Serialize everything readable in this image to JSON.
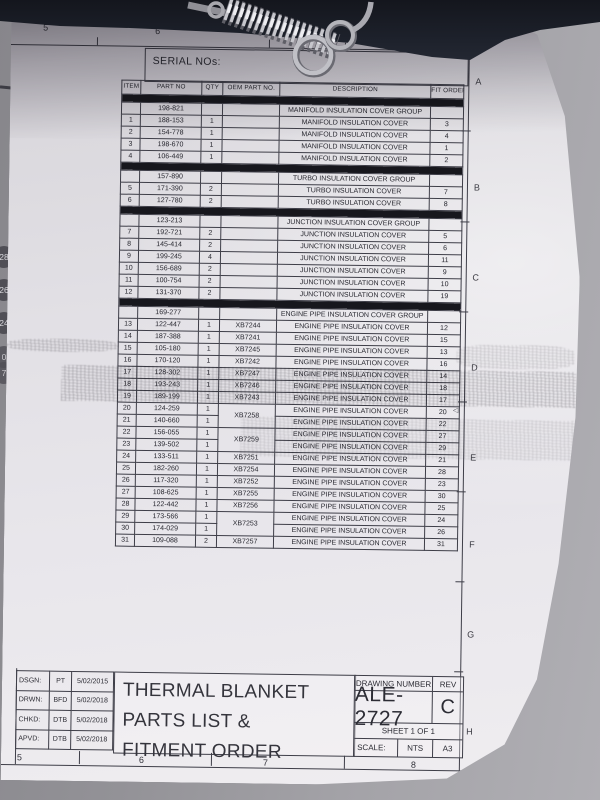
{
  "sheet": {
    "serial_label": "SERIAL NOs:",
    "zone_numbers_top": [
      "5",
      "6",
      "8"
    ],
    "zone_numbers_bottom": [
      "5",
      "6",
      "7",
      "8"
    ],
    "zone_letters": [
      "A",
      "B",
      "C",
      "D",
      "E",
      "F",
      "G",
      "H"
    ],
    "margin_balloons": [
      "28",
      "26",
      "24",
      "0",
      "7"
    ],
    "table": {
      "headers": [
        "ITEM",
        "PART NO",
        "QTY",
        "OEM PART NO.",
        "DESCRIPTION",
        "FIT ORDER"
      ],
      "rows": [
        {
          "type": "bar"
        },
        {
          "type": "group",
          "part": "198-821",
          "desc": "MANIFOLD INSULATION COVER GROUP"
        },
        {
          "type": "item",
          "item": "1",
          "part": "188-153",
          "qty": "1",
          "oem": "",
          "desc": "MANIFOLD INSULATION COVER",
          "fit": "3"
        },
        {
          "type": "item",
          "item": "2",
          "part": "154-778",
          "qty": "1",
          "oem": "",
          "desc": "MANIFOLD INSULATION COVER",
          "fit": "4"
        },
        {
          "type": "item",
          "item": "3",
          "part": "198-670",
          "qty": "1",
          "oem": "",
          "desc": "MANIFOLD INSULATION COVER",
          "fit": "1"
        },
        {
          "type": "item",
          "item": "4",
          "part": "106-449",
          "qty": "1",
          "oem": "",
          "desc": "MANIFOLD INSULATION COVER",
          "fit": "2"
        },
        {
          "type": "bar"
        },
        {
          "type": "group",
          "part": "157-890",
          "desc": "TURBO INSULATION COVER GROUP"
        },
        {
          "type": "item",
          "item": "5",
          "part": "171-390",
          "qty": "2",
          "oem": "",
          "desc": "TURBO INSULATION COVER",
          "fit": "7"
        },
        {
          "type": "item",
          "item": "6",
          "part": "127-780",
          "qty": "2",
          "oem": "",
          "desc": "TURBO INSULATION COVER",
          "fit": "8"
        },
        {
          "type": "bar"
        },
        {
          "type": "group",
          "part": "123-213",
          "desc": "JUNCTION INSULATION COVER GROUP"
        },
        {
          "type": "item",
          "item": "7",
          "part": "192-721",
          "qty": "2",
          "oem": "",
          "desc": "JUNCTION INSULATION COVER",
          "fit": "5"
        },
        {
          "type": "item",
          "item": "8",
          "part": "145-414",
          "qty": "2",
          "oem": "",
          "desc": "JUNCTION INSULATION COVER",
          "fit": "6"
        },
        {
          "type": "item",
          "item": "9",
          "part": "199-245",
          "qty": "4",
          "oem": "",
          "desc": "JUNCTION INSULATION COVER",
          "fit": "11"
        },
        {
          "type": "item",
          "item": "10",
          "part": "156-689",
          "qty": "2",
          "oem": "",
          "desc": "JUNCTION INSULATION COVER",
          "fit": "9"
        },
        {
          "type": "item",
          "item": "11",
          "part": "100-754",
          "qty": "2",
          "oem": "",
          "desc": "JUNCTION INSULATION COVER",
          "fit": "10"
        },
        {
          "type": "item",
          "item": "12",
          "part": "131-370",
          "qty": "2",
          "oem": "",
          "desc": "JUNCTION INSULATION COVER",
          "fit": "19"
        },
        {
          "type": "bar"
        },
        {
          "type": "group",
          "part": "169-277",
          "desc": "ENGINE PIPE INSULATION COVER GROUP"
        },
        {
          "type": "item",
          "item": "13",
          "part": "122-447",
          "qty": "1",
          "oem": "XB7244",
          "desc": "ENGINE PIPE INSULATION COVER",
          "fit": "12"
        },
        {
          "type": "item",
          "item": "14",
          "part": "187-388",
          "qty": "1",
          "oem": "XB7241",
          "desc": "ENGINE PIPE INSULATION COVER",
          "fit": "15"
        },
        {
          "type": "item",
          "item": "15",
          "part": "105-180",
          "qty": "1",
          "oem": "XB7245",
          "desc": "ENGINE PIPE INSULATION COVER",
          "fit": "13"
        },
        {
          "type": "item",
          "item": "16",
          "part": "170-120",
          "qty": "1",
          "oem": "XB7242",
          "desc": "ENGINE PIPE INSULATION COVER",
          "fit": "16"
        },
        {
          "type": "item",
          "item": "17",
          "part": "128-302",
          "qty": "1",
          "oem": "XB7247",
          "desc": "ENGINE PIPE INSULATION COVER",
          "fit": "14"
        },
        {
          "type": "item",
          "item": "18",
          "part": "193-243",
          "qty": "1",
          "oem": "XB7246",
          "desc": "ENGINE PIPE INSULATION COVER",
          "fit": "18"
        },
        {
          "type": "item",
          "item": "19",
          "part": "189-199",
          "qty": "1",
          "oem": "XB7243",
          "desc": "ENGINE PIPE INSULATION COVER",
          "fit": "17"
        },
        {
          "type": "item",
          "item": "20",
          "part": "124-259",
          "qty": "1",
          "oem": "XB7258",
          "oem_span": 2,
          "desc": "ENGINE PIPE INSULATION COVER",
          "fit": "20"
        },
        {
          "type": "item",
          "item": "21",
          "part": "140-660",
          "qty": "1",
          "oem_skip": true,
          "desc": "ENGINE PIPE INSULATION COVER",
          "fit": "22"
        },
        {
          "type": "item",
          "item": "22",
          "part": "156-055",
          "qty": "1",
          "oem": "XB7259",
          "oem_span": 2,
          "desc": "ENGINE PIPE INSULATION COVER",
          "fit": "27"
        },
        {
          "type": "item",
          "item": "23",
          "part": "139-502",
          "qty": "1",
          "oem_skip": true,
          "desc": "ENGINE PIPE INSULATION COVER",
          "fit": "29"
        },
        {
          "type": "item",
          "item": "24",
          "part": "133-511",
          "qty": "1",
          "oem": "XB7251",
          "desc": "ENGINE PIPE INSULATION COVER",
          "fit": "21"
        },
        {
          "type": "item",
          "item": "25",
          "part": "182-260",
          "qty": "1",
          "oem": "XB7254",
          "desc": "ENGINE PIPE INSULATION COVER",
          "fit": "28"
        },
        {
          "type": "item",
          "item": "26",
          "part": "117-320",
          "qty": "1",
          "oem": "XB7252",
          "desc": "ENGINE PIPE INSULATION COVER",
          "fit": "23"
        },
        {
          "type": "item",
          "item": "27",
          "part": "108-625",
          "qty": "1",
          "oem": "XB7255",
          "desc": "ENGINE PIPE INSULATION COVER",
          "fit": "30"
        },
        {
          "type": "item",
          "item": "28",
          "part": "122-442",
          "qty": "1",
          "oem": "XB7256",
          "desc": "ENGINE PIPE INSULATION COVER",
          "fit": "25"
        },
        {
          "type": "item",
          "item": "29",
          "part": "173-566",
          "qty": "1",
          "oem": "XB7253",
          "oem_span": 2,
          "desc": "ENGINE PIPE INSULATION COVER",
          "fit": "24"
        },
        {
          "type": "item",
          "item": "30",
          "part": "174-029",
          "qty": "1",
          "oem_skip": true,
          "desc": "ENGINE PIPE INSULATION COVER",
          "fit": "26"
        },
        {
          "type": "item",
          "item": "31",
          "part": "109-088",
          "qty": "2",
          "oem": "XB7257",
          "desc": "ENGINE PIPE INSULATION COVER",
          "fit": "31"
        }
      ]
    },
    "title_block": {
      "signoff": [
        {
          "label": "DSGN:",
          "initials": "PT",
          "date": "5/02/2015"
        },
        {
          "label": "DRWN:",
          "initials": "BFD",
          "date": "5/02/2018"
        },
        {
          "label": "CHKD:",
          "initials": "DTB",
          "date": "5/02/2018"
        },
        {
          "label": "APVD:",
          "initials": "DTB",
          "date": "5/02/2018"
        }
      ],
      "title_lines": [
        "THERMAL BLANKET",
        "PARTS LIST &",
        "FITMENT ORDER"
      ],
      "drawing_number_label": "DRAWING NUMBER",
      "rev_label": "REV",
      "drawing_number": "ALE-2727",
      "rev": "C",
      "sheet_text": "SHEET 1 OF 1",
      "scale_label": "SCALE:",
      "scale_value": "NTS",
      "paper_size": "A3"
    },
    "photo_objects": [
      "coil-spring",
      "metal-rings",
      "dark-fabric"
    ]
  }
}
